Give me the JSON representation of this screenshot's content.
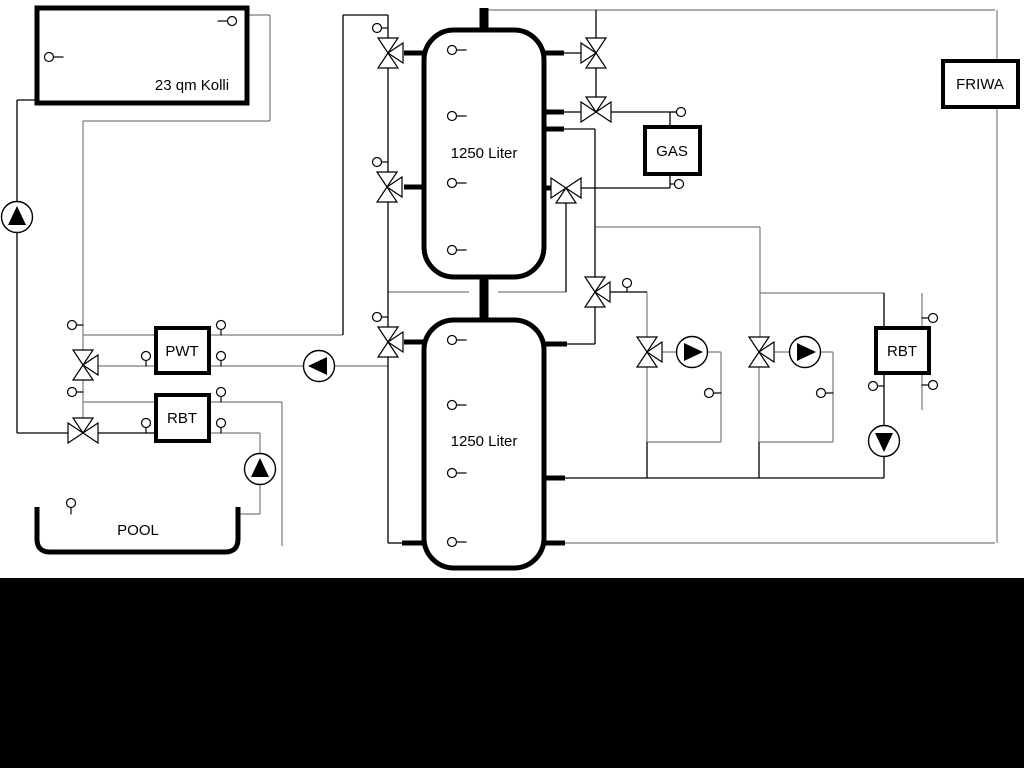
{
  "diagram": {
    "canvas": {
      "width": 1024,
      "height": 768,
      "background": "#ffffff",
      "gray": "#7c7c7c",
      "black": "#000000",
      "bottom_bar": {
        "x": 0,
        "y": 578,
        "width": 1024,
        "height": 190,
        "color": "#000000"
      }
    },
    "labels": {
      "collector": "23 qm Kolli",
      "tank_upper": "1250 Liter",
      "tank_lower": "1250 Liter",
      "pwt": "PWT",
      "rbt_left": "RBT",
      "pool": "POOL",
      "gas": "GAS",
      "friwa": "FRIWA",
      "rbt_right": "RBT"
    },
    "boxes": [
      {
        "id": "collector-box",
        "label": "23 qm Kolli",
        "x": 37,
        "y": 8,
        "w": 210,
        "h": 95,
        "border": 5,
        "lx": 192,
        "ly": 90,
        "fs": 15
      },
      {
        "id": "pwt-box",
        "label": "PWT",
        "x": 156,
        "y": 328,
        "w": 53,
        "h": 45,
        "border": 4,
        "lx": 182,
        "ly": 356,
        "fs": 15
      },
      {
        "id": "rbt-left-box",
        "label": "RBT",
        "x": 156,
        "y": 395,
        "w": 53,
        "h": 46,
        "border": 4,
        "lx": 182,
        "ly": 423,
        "fs": 15
      },
      {
        "id": "gas-box",
        "label": "GAS",
        "x": 645,
        "y": 127,
        "w": 55,
        "h": 47,
        "border": 4,
        "lx": 672,
        "ly": 156,
        "fs": 15
      },
      {
        "id": "friwa-box",
        "label": "FRIWA",
        "x": 943,
        "y": 61,
        "w": 75,
        "h": 46,
        "border": 4,
        "lx": 980,
        "ly": 89,
        "fs": 15
      },
      {
        "id": "rbt-right-box",
        "label": "RBT",
        "x": 876,
        "y": 328,
        "w": 53,
        "h": 45,
        "border": 4,
        "lx": 902,
        "ly": 356,
        "fs": 15
      }
    ],
    "tanks": [
      {
        "id": "buffer-tank-upper",
        "label": "1250 Liter",
        "x": 424,
        "y": 30,
        "w": 120,
        "h": 247,
        "r": 30,
        "border": 5,
        "lx": 484,
        "ly": 158,
        "fs": 15
      },
      {
        "id": "buffer-tank-lower",
        "label": "1250 Liter",
        "x": 424,
        "y": 320,
        "w": 120,
        "h": 248,
        "r": 30,
        "border": 5,
        "lx": 484,
        "ly": 446,
        "fs": 15
      }
    ],
    "pool": {
      "id": "pool",
      "label": "POOL",
      "left": 37,
      "right": 238,
      "top": 507,
      "bottom": 552,
      "r": 13,
      "border": 5,
      "lx": 138,
      "ly": 535,
      "fs": 15
    },
    "segments_gray": [
      [
        484,
        10,
        995,
        10
      ],
      [
        247,
        15,
        270,
        15
      ],
      [
        270,
        15,
        270,
        121
      ],
      [
        83,
        121,
        270,
        121
      ],
      [
        83,
        121,
        83,
        433
      ],
      [
        83,
        335,
        156,
        335
      ],
      [
        209,
        335,
        343,
        335
      ],
      [
        83,
        366,
        156,
        366
      ],
      [
        209,
        366,
        388,
        366
      ],
      [
        83,
        402,
        156,
        402
      ],
      [
        209,
        402,
        282,
        402
      ],
      [
        282,
        402,
        282,
        546
      ],
      [
        209,
        433,
        260,
        433
      ],
      [
        260,
        433,
        260,
        514
      ],
      [
        238,
        514,
        260,
        514
      ],
      [
        388,
        292,
        469,
        292
      ],
      [
        498,
        292,
        566,
        292
      ],
      [
        595,
        227,
        760,
        227
      ],
      [
        760,
        227,
        760,
        352
      ],
      [
        760,
        293,
        884,
        293
      ],
      [
        922,
        293,
        922,
        410
      ],
      [
        647,
        292,
        647,
        352
      ],
      [
        647,
        352,
        721,
        352
      ],
      [
        721,
        352,
        721,
        442
      ],
      [
        647,
        442,
        721,
        442
      ],
      [
        759,
        352,
        833,
        352
      ],
      [
        833,
        352,
        833,
        442
      ],
      [
        759,
        442,
        833,
        442
      ],
      [
        647,
        352,
        647,
        442
      ],
      [
        759,
        352,
        759,
        442
      ],
      [
        997,
        10,
        997,
        543
      ],
      [
        565,
        543,
        995,
        543
      ]
    ],
    "segments_black": [
      [
        17,
        100,
        37,
        100
      ],
      [
        17,
        100,
        17,
        433
      ],
      [
        17,
        433,
        156,
        433
      ],
      [
        343,
        15,
        388,
        15
      ],
      [
        343,
        15,
        343,
        335
      ],
      [
        388,
        15,
        388,
        543
      ],
      [
        388,
        543,
        404,
        543
      ],
      [
        564,
        53,
        596,
        53
      ],
      [
        596,
        10,
        596,
        112
      ],
      [
        564,
        112,
        596,
        112
      ],
      [
        596,
        112,
        676,
        112
      ],
      [
        670,
        112,
        670,
        127
      ],
      [
        670,
        174,
        670,
        188
      ],
      [
        566,
        188,
        670,
        188
      ],
      [
        564,
        129,
        595,
        129
      ],
      [
        595,
        129,
        595,
        344
      ],
      [
        567,
        344,
        595,
        344
      ],
      [
        595,
        292,
        647,
        292
      ],
      [
        566,
        188,
        566,
        292
      ],
      [
        647,
        442,
        647,
        478
      ],
      [
        759,
        442,
        759,
        478
      ],
      [
        565,
        478,
        884,
        478
      ],
      [
        884,
        293,
        884,
        478
      ]
    ],
    "stubs": [
      [
        404,
        53,
        425,
        53
      ],
      [
        404,
        187,
        425,
        187
      ],
      [
        404,
        342,
        425,
        342
      ],
      [
        402,
        543,
        425,
        543
      ],
      [
        543,
        53,
        564,
        53
      ],
      [
        543,
        112,
        564,
        112
      ],
      [
        543,
        129,
        564,
        129
      ],
      [
        543,
        188,
        558,
        188
      ],
      [
        543,
        344,
        567,
        344
      ],
      [
        543,
        478,
        565,
        478
      ],
      [
        543,
        543,
        565,
        543
      ]
    ],
    "pipes": [
      [
        484,
        8,
        484,
        31
      ],
      [
        484,
        275,
        484,
        322
      ]
    ],
    "valves": [
      {
        "x": 388,
        "y": 53,
        "tris": [
          "up",
          "down",
          "right"
        ]
      },
      {
        "x": 387,
        "y": 187,
        "tris": [
          "up",
          "down",
          "right"
        ]
      },
      {
        "x": 388,
        "y": 342,
        "tris": [
          "up",
          "down",
          "right"
        ]
      },
      {
        "x": 596,
        "y": 53,
        "tris": [
          "up",
          "down",
          "left"
        ]
      },
      {
        "x": 596,
        "y": 112,
        "tris": [
          "left",
          "right",
          "up"
        ]
      },
      {
        "x": 566,
        "y": 188,
        "tris": [
          "left",
          "right",
          "down"
        ]
      },
      {
        "x": 595,
        "y": 292,
        "tris": [
          "up",
          "down",
          "right"
        ]
      },
      {
        "x": 647,
        "y": 352,
        "tris": [
          "up",
          "down",
          "right"
        ]
      },
      {
        "x": 759,
        "y": 352,
        "tris": [
          "up",
          "down",
          "right"
        ]
      },
      {
        "x": 83,
        "y": 365,
        "tris": [
          "up",
          "down",
          "right"
        ]
      },
      {
        "x": 83,
        "y": 433,
        "tris": [
          "left",
          "right",
          "up"
        ]
      }
    ],
    "pumps": [
      {
        "x": 17,
        "y": 217,
        "dir": "up"
      },
      {
        "x": 319,
        "y": 366,
        "dir": "left"
      },
      {
        "x": 260,
        "y": 469,
        "dir": "up"
      },
      {
        "x": 692,
        "y": 352,
        "dir": "right"
      },
      {
        "x": 805,
        "y": 352,
        "dir": "right"
      },
      {
        "x": 884,
        "y": 441,
        "dir": "down"
      }
    ],
    "sensors": [
      {
        "x": 49,
        "y": 57,
        "stub": "right",
        "len": 10
      },
      {
        "x": 232,
        "y": 21,
        "stub": "left",
        "len": 10
      },
      {
        "x": 72,
        "y": 325,
        "stub": "right",
        "len": 7
      },
      {
        "x": 72,
        "y": 392,
        "stub": "right",
        "len": 7
      },
      {
        "x": 146,
        "y": 356,
        "stub": "down",
        "len": 6
      },
      {
        "x": 221,
        "y": 325,
        "stub": "down",
        "len": 6
      },
      {
        "x": 221,
        "y": 356,
        "stub": "down",
        "len": 6
      },
      {
        "x": 146,
        "y": 423,
        "stub": "down",
        "len": 6
      },
      {
        "x": 221,
        "y": 392,
        "stub": "down",
        "len": 6
      },
      {
        "x": 221,
        "y": 423,
        "stub": "down",
        "len": 6
      },
      {
        "x": 71,
        "y": 503,
        "stub": "down",
        "len": 7
      },
      {
        "x": 377,
        "y": 28,
        "stub": "right",
        "len": 7
      },
      {
        "x": 377,
        "y": 162,
        "stub": "right",
        "len": 7
      },
      {
        "x": 377,
        "y": 317,
        "stub": "right",
        "len": 7
      },
      {
        "x": 452,
        "y": 50,
        "stub": "right",
        "len": 10
      },
      {
        "x": 452,
        "y": 116,
        "stub": "right",
        "len": 10
      },
      {
        "x": 452,
        "y": 183,
        "stub": "right",
        "len": 10
      },
      {
        "x": 452,
        "y": 250,
        "stub": "right",
        "len": 10
      },
      {
        "x": 452,
        "y": 340,
        "stub": "right",
        "len": 10
      },
      {
        "x": 452,
        "y": 405,
        "stub": "right",
        "len": 10
      },
      {
        "x": 452,
        "y": 473,
        "stub": "right",
        "len": 10
      },
      {
        "x": 452,
        "y": 542,
        "stub": "right",
        "len": 10
      },
      {
        "x": 627,
        "y": 283,
        "stub": "down",
        "len": 5
      },
      {
        "x": 709,
        "y": 393,
        "stub": "right",
        "len": 8
      },
      {
        "x": 821,
        "y": 393,
        "stub": "right",
        "len": 8
      },
      {
        "x": 873,
        "y": 386,
        "stub": "right",
        "len": 7
      },
      {
        "x": 933,
        "y": 318,
        "stub": "left",
        "len": 7
      },
      {
        "x": 933,
        "y": 385,
        "stub": "left",
        "len": 7
      },
      {
        "x": 681,
        "y": 112,
        "stub": "left",
        "len": 5
      },
      {
        "x": 679,
        "y": 184,
        "stub": "left",
        "len": 5
      }
    ]
  }
}
